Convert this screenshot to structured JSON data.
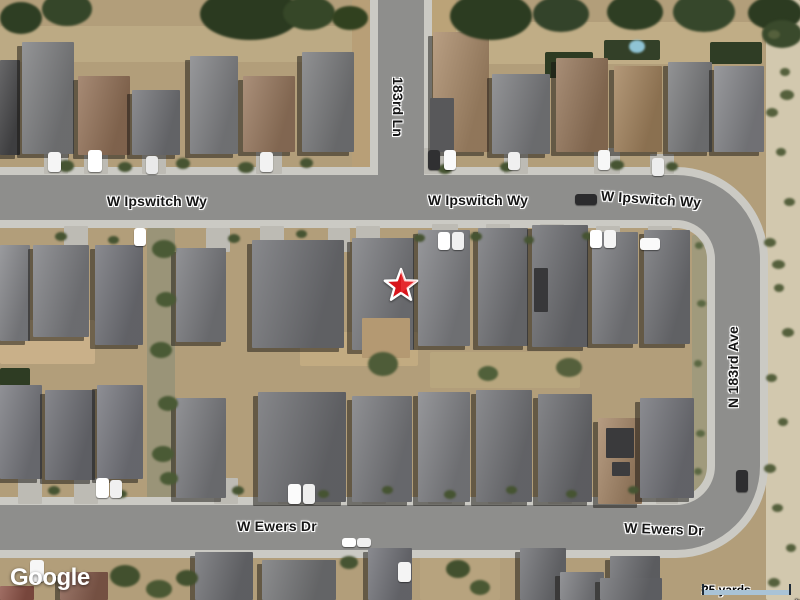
{
  "controls": {
    "logo": "Google",
    "scale_label": "25 yards",
    "attribution_map_data": "Map data ©2023",
    "attribution_imagery": "Imagery ©2023 Airbus, CNES / Airbus, Maxar Technologies, U.S. Geological Survey"
  },
  "colors": {
    "dirt": "#b29e7a",
    "desert": "#d2c8ae",
    "road": "#8e8e8c",
    "sidewalk": "#cbcac4",
    "marker_fill": "#d8151c",
    "marker_outline": "#ffffff",
    "scalebar_fill": "#a9c3d6",
    "scalebar_cap": "#1e2b38",
    "label_text": "#151515",
    "label_halo": "#ffffff"
  },
  "map": {
    "street_labels": [
      {
        "text": "W Ipswitch Wy",
        "x": 157,
        "y": 201,
        "rotate": 0
      },
      {
        "text": "W Ipswitch Wy",
        "x": 478,
        "y": 200,
        "rotate": 0
      },
      {
        "text": "W Ipswitch Wy",
        "x": 651,
        "y": 199,
        "rotate": 4
      },
      {
        "text": "183rd Ln",
        "x": 398,
        "y": 107,
        "rotate": 90
      },
      {
        "text": "N 183rd Ave",
        "x": 733,
        "y": 367,
        "rotate": -90
      },
      {
        "text": "W Ewers Dr",
        "x": 277,
        "y": 526,
        "rotate": 0
      },
      {
        "text": "W Ewers Dr",
        "x": 664,
        "y": 529,
        "rotate": 2
      }
    ],
    "marker": {
      "type": "star",
      "x": 401,
      "y": 286
    },
    "features": {
      "terrain": [
        [
          766,
          0,
          34,
          600,
          "#d2c8ae"
        ],
        [
          0,
          26,
          368,
          36,
          "#bcaa84"
        ],
        [
          432,
          22,
          330,
          42,
          "#c0ad86"
        ],
        [
          448,
          44,
          40,
          32,
          "#2c3a21"
        ],
        [
          545,
          52,
          48,
          26,
          "#2d3b22"
        ],
        [
          604,
          40,
          56,
          20,
          "#334028"
        ],
        [
          710,
          42,
          52,
          22,
          "#2f3d25"
        ],
        [
          352,
          0,
          18,
          172,
          "#b89f77"
        ],
        [
          430,
          0,
          26,
          150,
          "#bba378"
        ],
        [
          147,
          228,
          28,
          270,
          "#9a9478"
        ],
        [
          692,
          235,
          15,
          262,
          "#a09a7c"
        ],
        [
          0,
          320,
          95,
          44,
          "#c9b089"
        ],
        [
          300,
          332,
          118,
          34,
          "#c2ab81"
        ],
        [
          0,
          368,
          30,
          18,
          "#2e3c23"
        ],
        [
          430,
          352,
          150,
          36,
          "#b8a67e"
        ],
        [
          420,
          556,
          80,
          44,
          "#b7a37e"
        ]
      ],
      "driveways": [
        [
          44,
          150,
          24,
          24
        ],
        [
          84,
          150,
          24,
          24
        ],
        [
          142,
          152,
          24,
          22
        ],
        [
          256,
          150,
          26,
          24
        ],
        [
          424,
          148,
          28,
          26
        ],
        [
          504,
          150,
          24,
          24
        ],
        [
          594,
          148,
          26,
          26
        ],
        [
          650,
          154,
          24,
          20
        ],
        [
          64,
          226,
          24,
          26
        ],
        [
          206,
          228,
          24,
          24
        ],
        [
          260,
          226,
          24,
          26
        ],
        [
          328,
          228,
          22,
          24
        ],
        [
          356,
          226,
          24,
          26
        ],
        [
          432,
          224,
          26,
          28
        ],
        [
          486,
          224,
          24,
          28
        ],
        [
          540,
          224,
          24,
          28
        ],
        [
          596,
          226,
          24,
          26
        ],
        [
          648,
          226,
          24,
          26
        ],
        [
          18,
          478,
          24,
          26
        ],
        [
          74,
          478,
          24,
          26
        ],
        [
          214,
          478,
          24,
          26
        ],
        [
          278,
          478,
          26,
          26
        ],
        [
          362,
          478,
          24,
          26
        ],
        [
          428,
          478,
          24,
          26
        ],
        [
          488,
          478,
          24,
          26
        ],
        [
          548,
          478,
          24,
          26
        ],
        [
          606,
          478,
          24,
          26
        ],
        [
          656,
          478,
          22,
          26
        ]
      ],
      "houses": [
        [
          0,
          60,
          20,
          95,
          "#4a4a4c"
        ],
        [
          22,
          42,
          52,
          112,
          "#7f8082"
        ],
        [
          78,
          76,
          52,
          79,
          "#96745a"
        ],
        [
          132,
          90,
          48,
          65,
          "#75767a"
        ],
        [
          190,
          56,
          48,
          98,
          "#838487"
        ],
        [
          243,
          76,
          52,
          76,
          "#9a7a60"
        ],
        [
          302,
          52,
          52,
          100,
          "#7b7c7e"
        ],
        [
          433,
          32,
          56,
          120,
          "#ab8c6b"
        ],
        [
          492,
          74,
          58,
          80,
          "#7e7f82"
        ],
        [
          556,
          58,
          52,
          94,
          "#97785c"
        ],
        [
          614,
          66,
          48,
          86,
          "#a5855f"
        ],
        [
          668,
          62,
          44,
          90,
          "#7d7e80"
        ],
        [
          714,
          66,
          50,
          86,
          "#85868a"
        ],
        [
          0,
          245,
          30,
          96,
          "#86878b"
        ],
        [
          33,
          245,
          56,
          92,
          "#7f8084"
        ],
        [
          95,
          245,
          48,
          100,
          "#73747a"
        ],
        [
          176,
          248,
          50,
          94,
          "#7c7d81"
        ],
        [
          252,
          240,
          92,
          108,
          "#717276"
        ],
        [
          352,
          238,
          62,
          112,
          "#7b7c80"
        ],
        [
          418,
          230,
          52,
          116,
          "#838488"
        ],
        [
          478,
          228,
          50,
          118,
          "#75767a"
        ],
        [
          532,
          225,
          56,
          122,
          "#6e6f73"
        ],
        [
          592,
          232,
          46,
          112,
          "#7d7e82"
        ],
        [
          644,
          230,
          46,
          114,
          "#727377"
        ],
        [
          0,
          385,
          42,
          94,
          "#7a7b81"
        ],
        [
          45,
          390,
          50,
          90,
          "#6f7076"
        ],
        [
          97,
          385,
          46,
          94,
          "#787980"
        ],
        [
          176,
          398,
          50,
          100,
          "#7c7d81"
        ],
        [
          258,
          392,
          88,
          110,
          "#6f7074"
        ],
        [
          352,
          396,
          60,
          106,
          "#7a7b7f"
        ],
        [
          418,
          392,
          52,
          110,
          "#828387"
        ],
        [
          476,
          390,
          56,
          112,
          "#747579"
        ],
        [
          538,
          394,
          54,
          108,
          "#6d6e72"
        ],
        [
          598,
          418,
          44,
          86,
          "#a8896a"
        ],
        [
          640,
          398,
          54,
          100,
          "#74757b"
        ],
        [
          0,
          586,
          34,
          14,
          "#8e5347"
        ],
        [
          60,
          572,
          48,
          28,
          "#8a5f4f"
        ],
        [
          195,
          552,
          58,
          48,
          "#6f7074"
        ],
        [
          262,
          560,
          74,
          40,
          "#767779"
        ],
        [
          368,
          548,
          44,
          52,
          "#73747a"
        ],
        [
          520,
          548,
          46,
          52,
          "#707175"
        ],
        [
          560,
          572,
          44,
          28,
          "#7d7e82"
        ],
        [
          610,
          556,
          50,
          44,
          "#6c6d71"
        ],
        [
          600,
          578,
          62,
          22,
          "#6e6f73"
        ]
      ],
      "details": [
        [
          534,
          268,
          14,
          44,
          "#38383a"
        ],
        [
          362,
          318,
          48,
          40,
          "#b49972"
        ],
        [
          606,
          428,
          28,
          30,
          "#3a3a3c"
        ],
        [
          612,
          462,
          18,
          14,
          "#3c3c3e"
        ],
        [
          430,
          98,
          24,
          54,
          "#58585a"
        ]
      ],
      "vegetation": [
        [
          0,
          2,
          42,
          32,
          "#2e3e23"
        ],
        [
          42,
          -8,
          50,
          34,
          "#354629"
        ],
        [
          200,
          -12,
          100,
          52,
          "#2b3a20"
        ],
        [
          283,
          -4,
          52,
          34,
          "#364728"
        ],
        [
          332,
          6,
          36,
          24,
          "#31411f"
        ],
        [
          450,
          -8,
          82,
          48,
          "#2c3c21"
        ],
        [
          533,
          -4,
          56,
          36,
          "#33432a"
        ],
        [
          607,
          -6,
          56,
          36,
          "#2e3e23"
        ],
        [
          673,
          -8,
          62,
          40,
          "#36472b"
        ],
        [
          748,
          -4,
          54,
          34,
          "#2c3b21"
        ],
        [
          762,
          20,
          40,
          28,
          "#3a4a2c"
        ],
        [
          58,
          160,
          16,
          12,
          "#465432"
        ],
        [
          118,
          162,
          14,
          10,
          "#465432"
        ],
        [
          176,
          158,
          14,
          11,
          "#465432"
        ],
        [
          238,
          162,
          16,
          11,
          "#465432"
        ],
        [
          300,
          158,
          13,
          10,
          "#465432"
        ],
        [
          438,
          164,
          14,
          10,
          "#465432"
        ],
        [
          500,
          162,
          13,
          10,
          "#465432"
        ],
        [
          610,
          160,
          14,
          10,
          "#465432"
        ],
        [
          666,
          162,
          12,
          9,
          "#465432"
        ],
        [
          55,
          232,
          12,
          9,
          "#465432"
        ],
        [
          108,
          236,
          11,
          8,
          "#465432"
        ],
        [
          228,
          234,
          12,
          9,
          "#465432"
        ],
        [
          296,
          230,
          11,
          8,
          "#465432"
        ],
        [
          414,
          234,
          11,
          8,
          "#465432"
        ],
        [
          470,
          232,
          12,
          9,
          "#465432"
        ],
        [
          524,
          236,
          10,
          8,
          "#465432"
        ],
        [
          582,
          232,
          11,
          8,
          "#465432"
        ],
        [
          152,
          240,
          24,
          18,
          "#4a5a35"
        ],
        [
          156,
          292,
          20,
          15,
          "#4a5a35"
        ],
        [
          150,
          342,
          22,
          16,
          "#4a5a35"
        ],
        [
          158,
          396,
          20,
          15,
          "#4a5a35"
        ],
        [
          152,
          446,
          22,
          16,
          "#4a5a35"
        ],
        [
          160,
          472,
          18,
          13,
          "#4a5a35"
        ],
        [
          368,
          352,
          30,
          24,
          "#4e5c38"
        ],
        [
          556,
          358,
          26,
          19,
          "#55603c"
        ],
        [
          478,
          366,
          20,
          15,
          "#50603a"
        ],
        [
          48,
          486,
          12,
          9,
          "#465432"
        ],
        [
          116,
          490,
          11,
          8,
          "#465432"
        ],
        [
          232,
          486,
          12,
          9,
          "#465432"
        ],
        [
          318,
          490,
          11,
          8,
          "#465432"
        ],
        [
          382,
          486,
          11,
          8,
          "#465432"
        ],
        [
          444,
          490,
          12,
          9,
          "#465432"
        ],
        [
          506,
          486,
          11,
          8,
          "#465432"
        ],
        [
          566,
          490,
          11,
          8,
          "#465432"
        ],
        [
          628,
          486,
          11,
          8,
          "#465432"
        ],
        [
          110,
          565,
          30,
          22,
          "#42502e"
        ],
        [
          146,
          580,
          26,
          18,
          "#4a5833"
        ],
        [
          176,
          570,
          22,
          16,
          "#42502e"
        ],
        [
          446,
          560,
          24,
          18,
          "#42502e"
        ],
        [
          470,
          580,
          20,
          15,
          "#4a5833"
        ],
        [
          340,
          556,
          18,
          13,
          "#465432"
        ],
        [
          768,
          30,
          12,
          9,
          "#55603c"
        ],
        [
          780,
          68,
          10,
          8,
          "#55603c"
        ],
        [
          766,
          108,
          12,
          9,
          "#55603c"
        ],
        [
          776,
          148,
          10,
          8,
          "#55603c"
        ],
        [
          784,
          198,
          11,
          8,
          "#55603c"
        ],
        [
          764,
          238,
          12,
          9,
          "#55603c"
        ],
        [
          774,
          284,
          10,
          8,
          "#55603c"
        ],
        [
          782,
          328,
          12,
          9,
          "#55603c"
        ],
        [
          766,
          374,
          11,
          8,
          "#55603c"
        ],
        [
          778,
          418,
          10,
          8,
          "#55603c"
        ],
        [
          764,
          464,
          12,
          9,
          "#55603c"
        ],
        [
          772,
          504,
          11,
          8,
          "#55603c"
        ],
        [
          786,
          544,
          10,
          8,
          "#55603c"
        ],
        [
          768,
          578,
          12,
          9,
          "#55603c"
        ],
        [
          780,
          90,
          14,
          10,
          "#55603c"
        ],
        [
          772,
          260,
          13,
          9,
          "#55603c"
        ],
        [
          695,
          242,
          8,
          7,
          "#5a6742"
        ],
        [
          697,
          300,
          9,
          7,
          "#5a6742"
        ],
        [
          694,
          360,
          8,
          7,
          "#5a6742"
        ],
        [
          696,
          430,
          9,
          7,
          "#5a6742"
        ],
        [
          694,
          468,
          8,
          7,
          "#5a6742"
        ],
        [
          629,
          40,
          16,
          13,
          "#8fc3d4"
        ]
      ],
      "cars": [
        [
          48,
          152,
          13,
          20,
          "#f5f5f5"
        ],
        [
          88,
          150,
          14,
          22,
          "#ffffff"
        ],
        [
          146,
          156,
          12,
          18,
          "#e9e9e9"
        ],
        [
          260,
          152,
          13,
          20,
          "#f2f2f2"
        ],
        [
          428,
          150,
          12,
          20,
          "#303032"
        ],
        [
          444,
          150,
          12,
          20,
          "#fafafa"
        ],
        [
          508,
          152,
          12,
          18,
          "#f0f0f0"
        ],
        [
          598,
          150,
          12,
          20,
          "#f7f7f7"
        ],
        [
          652,
          158,
          12,
          18,
          "#ededed"
        ],
        [
          575,
          194,
          22,
          11,
          "#2b2b2d"
        ],
        [
          134,
          228,
          12,
          18,
          "#ffffff"
        ],
        [
          438,
          232,
          12,
          18,
          "#ffffff"
        ],
        [
          452,
          232,
          12,
          18,
          "#f0f0f0"
        ],
        [
          590,
          230,
          12,
          18,
          "#ffffff"
        ],
        [
          604,
          230,
          12,
          18,
          "#f4f4f4"
        ],
        [
          640,
          238,
          20,
          12,
          "#fafafa"
        ],
        [
          96,
          478,
          13,
          20,
          "#ffffff"
        ],
        [
          110,
          480,
          12,
          18,
          "#f0f0f0"
        ],
        [
          288,
          484,
          13,
          20,
          "#fbfbfb"
        ],
        [
          303,
          484,
          12,
          20,
          "#eeeeee"
        ],
        [
          342,
          538,
          14,
          9,
          "#ffffff"
        ],
        [
          357,
          538,
          14,
          9,
          "#f0f0f0"
        ],
        [
          736,
          470,
          12,
          22,
          "#2e2e30"
        ],
        [
          30,
          560,
          14,
          22,
          "#f6f6f6"
        ],
        [
          398,
          562,
          13,
          20,
          "#f4f4f4"
        ]
      ]
    }
  }
}
